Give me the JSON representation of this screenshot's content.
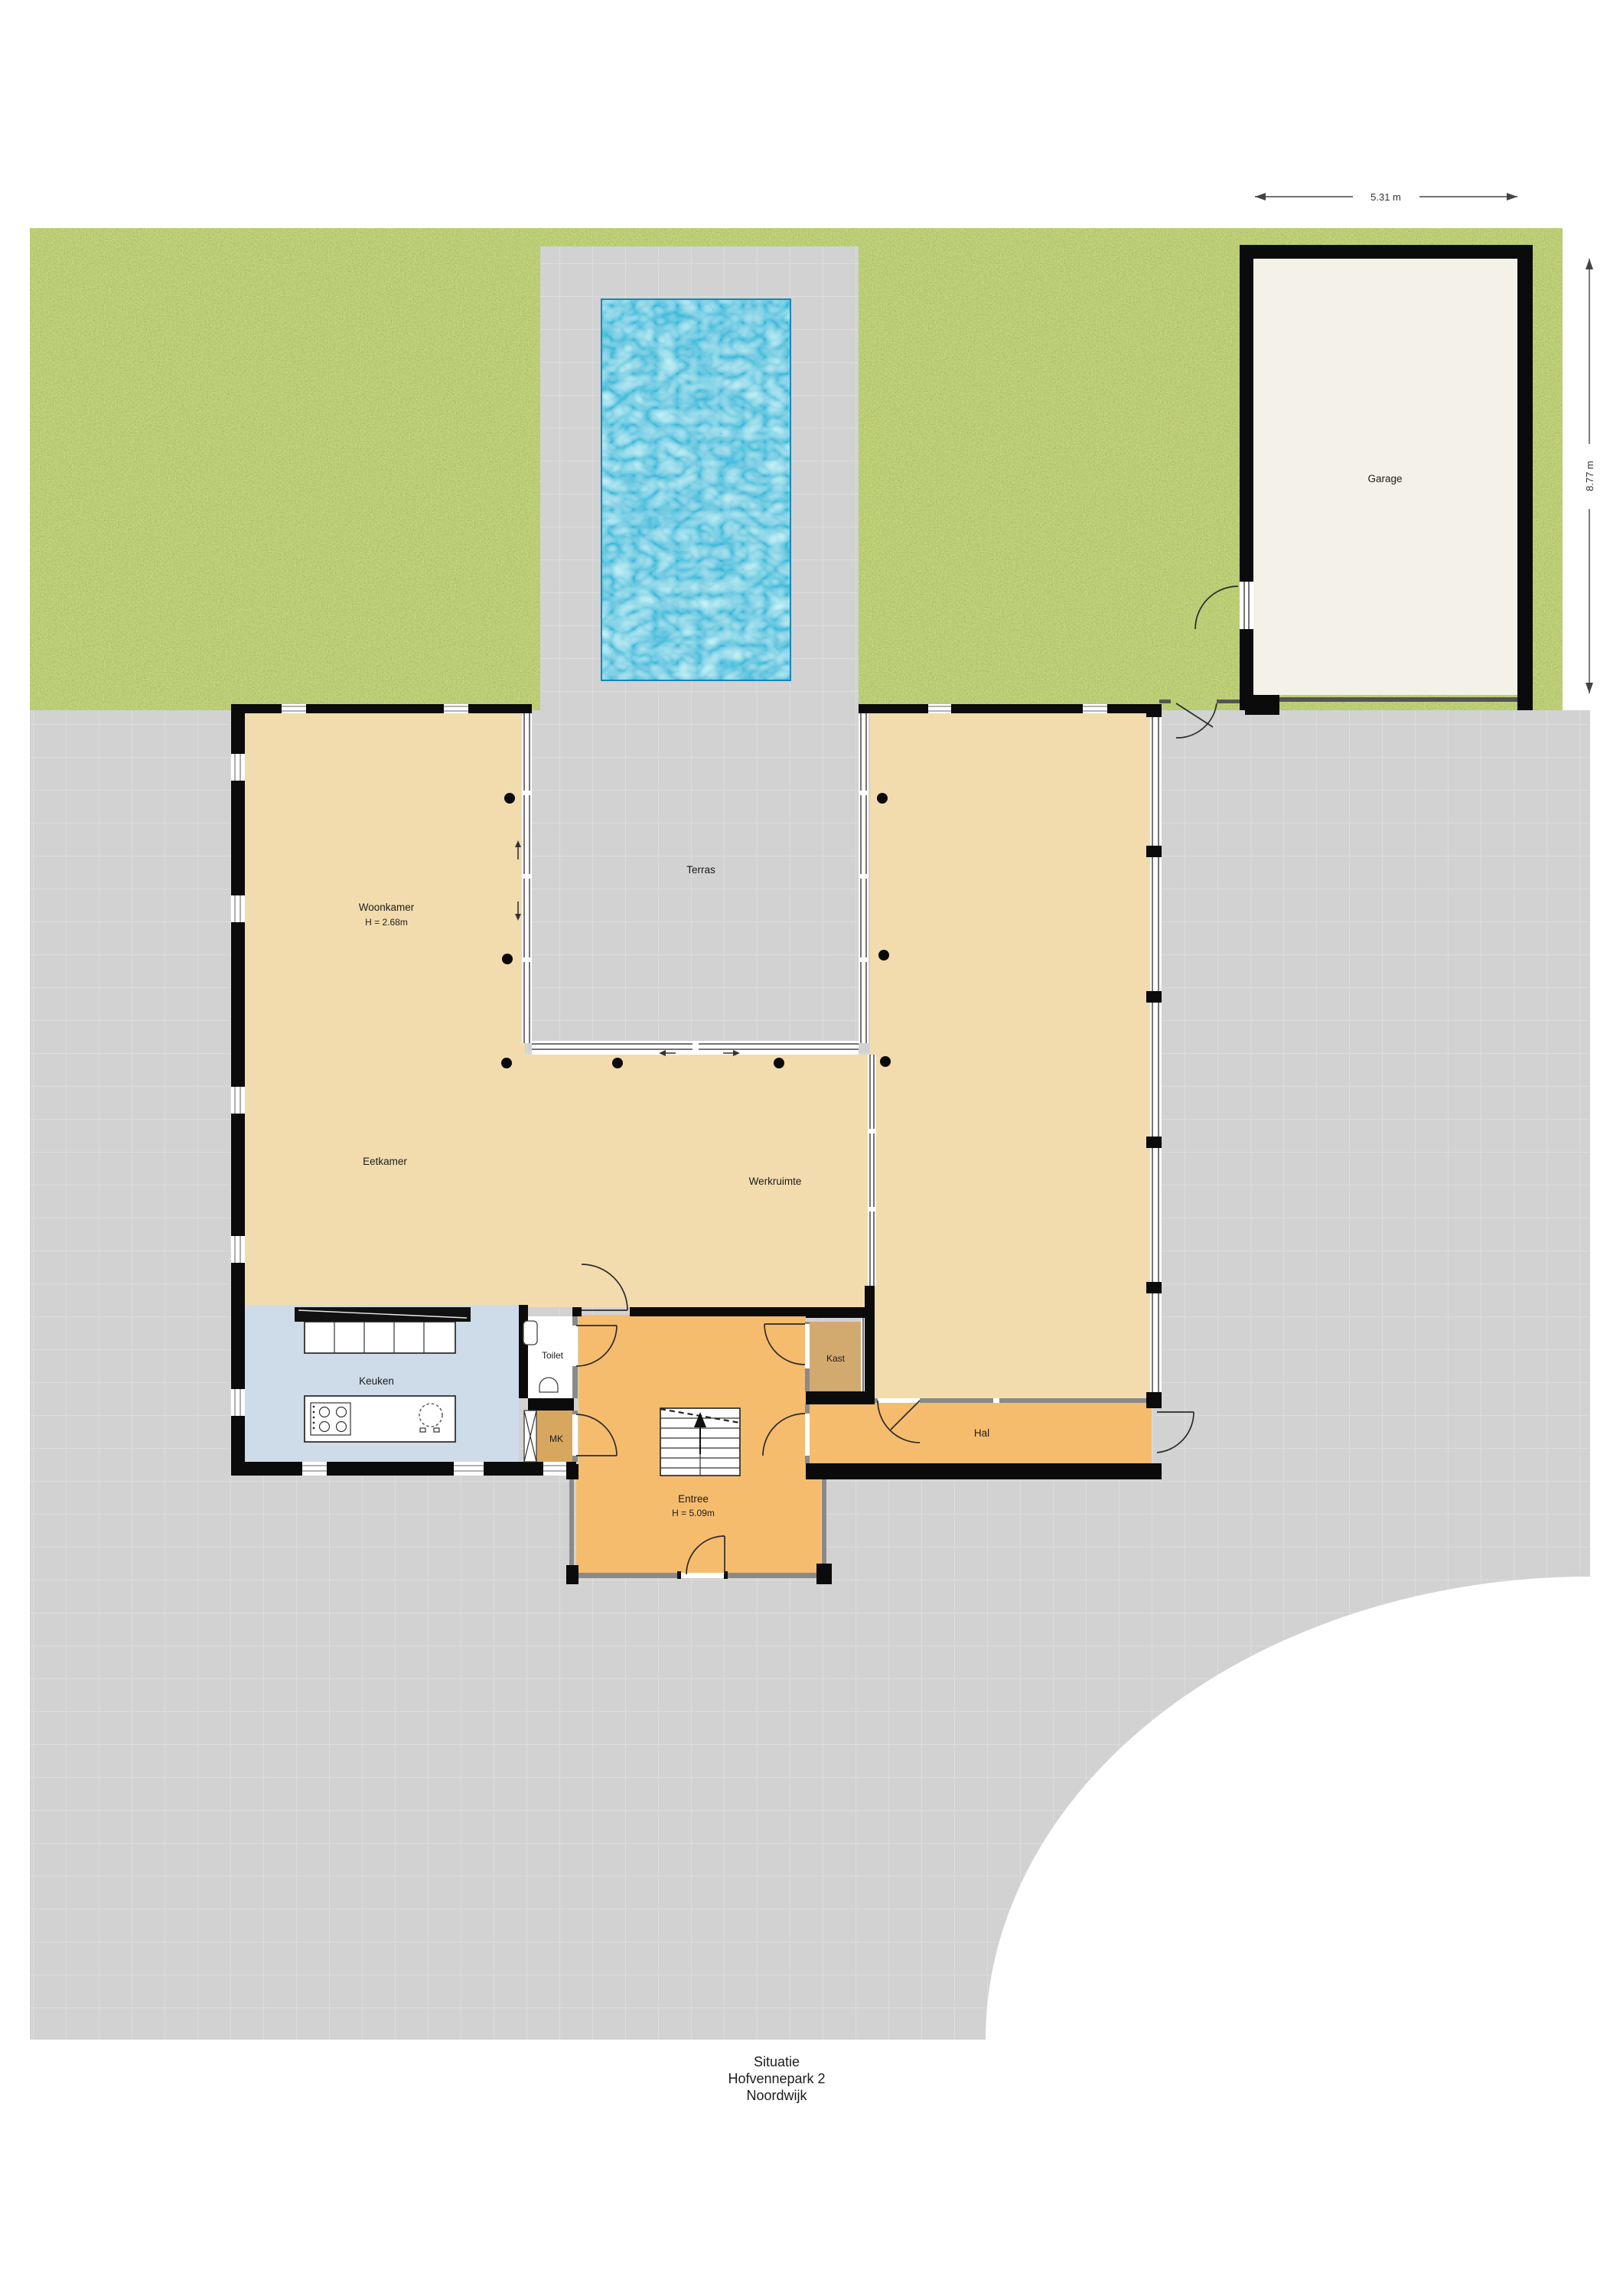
{
  "plan": {
    "type": "situation-floor-plan",
    "rooms": {
      "woonkamer": {
        "label": "Woonkamer",
        "height": "H = 2.68m"
      },
      "terras": {
        "label": "Terras"
      },
      "eetkamer": {
        "label": "Eetkamer"
      },
      "werkruimte": {
        "label": "Werkruimte"
      },
      "keuken": {
        "label": "Keuken"
      },
      "toilet": {
        "label": "Toilet"
      },
      "mk": {
        "label": "MK"
      },
      "kast": {
        "label": "Kast"
      },
      "hal": {
        "label": "Hal"
      },
      "entree": {
        "label": "Entree",
        "height": "H = 5.09m"
      },
      "garage": {
        "label": "Garage"
      }
    },
    "dimensions": {
      "garage_width": "5.31 m",
      "garage_depth": "8.77 m"
    },
    "title_block": {
      "line1": "Situatie",
      "line2": "Hofvennepark 2",
      "line3": "Noordwijk"
    },
    "colors": {
      "grass": "#82993a",
      "paving": "#d2d2d2",
      "paving_grid": "#dcdcdc",
      "pool_water": "#2aa9d6",
      "room_beige": "#f2dcae",
      "kitchen_blue": "#cedce9",
      "entree_orange": "#f6bc6d",
      "mk_tan": "#d7a75f",
      "kast_tan": "#d2aa70",
      "garage_floor": "#f4f2e8",
      "wall": "#0b0b0b"
    }
  }
}
